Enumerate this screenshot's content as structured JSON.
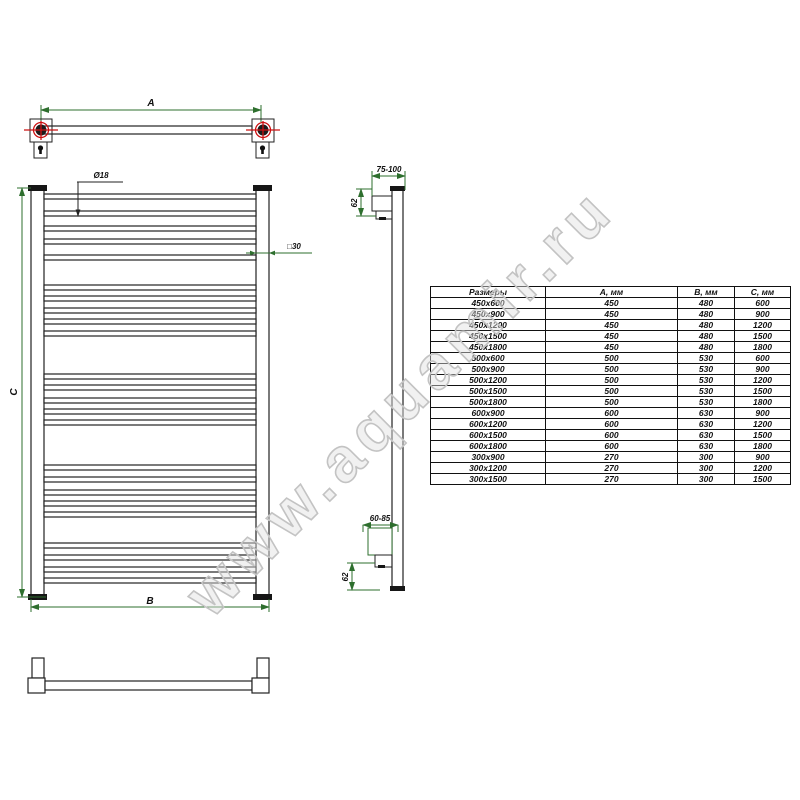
{
  "watermark": {
    "text": "www.aquamir.ru"
  },
  "drawing": {
    "labels": {
      "top_width": "А",
      "rung_diameter": "Ø18",
      "post_section": "□30",
      "height": "С",
      "overall_width": "В",
      "side_top_depth": "75-100",
      "side_top_offset": "62",
      "side_bottom_depth": "60-85",
      "side_bottom_offset": "62"
    }
  },
  "size_table": {
    "headers": [
      "Размеры",
      "А, мм",
      "В, мм",
      "С, мм"
    ],
    "rows": [
      [
        "450x600",
        "450",
        "480",
        "600"
      ],
      [
        "450x900",
        "450",
        "480",
        "900"
      ],
      [
        "450x1200",
        "450",
        "480",
        "1200"
      ],
      [
        "450x1500",
        "450",
        "480",
        "1500"
      ],
      [
        "450x1800",
        "450",
        "480",
        "1800"
      ],
      [
        "500x600",
        "500",
        "530",
        "600"
      ],
      [
        "500x900",
        "500",
        "530",
        "900"
      ],
      [
        "500x1200",
        "500",
        "530",
        "1200"
      ],
      [
        "500x1500",
        "500",
        "530",
        "1500"
      ],
      [
        "500x1800",
        "500",
        "530",
        "1800"
      ],
      [
        "600x900",
        "600",
        "630",
        "900"
      ],
      [
        "600x1200",
        "600",
        "630",
        "1200"
      ],
      [
        "600x1500",
        "600",
        "630",
        "1500"
      ],
      [
        "600x1800",
        "600",
        "630",
        "1800"
      ],
      [
        "300x900",
        "270",
        "300",
        "900"
      ],
      [
        "300x1200",
        "270",
        "300",
        "1200"
      ],
      [
        "300x1500",
        "270",
        "300",
        "1500"
      ]
    ]
  },
  "colors": {
    "dimension_green": "#2e6f2e",
    "centerline_red": "#cc1111",
    "drawing_black": "#222222",
    "watermark_gray": "#c3c3c3"
  }
}
